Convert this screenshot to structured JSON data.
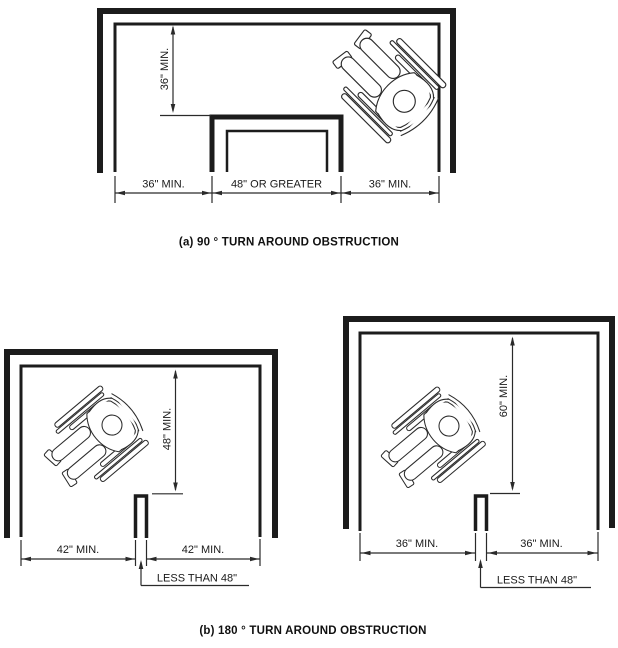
{
  "figure": {
    "background": "#ffffff",
    "line_color": "#1c1c1c",
    "wheelchair_figure": "wheelchair-user-top-view"
  },
  "diagram_a": {
    "title": "90 degree turn around obstruction",
    "caption": "(a) 90 ° TURN AROUND OBSTRUCTION",
    "vertical_dim": "36\" MIN.",
    "bottom_left_dim": "36\" MIN.",
    "bottom_center_dim": "48\" OR GREATER",
    "bottom_right_dim": "36\" MIN."
  },
  "diagram_b_left": {
    "vertical_dim": "48\" MIN.",
    "bottom_left_dim": "42\" MIN.",
    "bottom_right_dim": "42\" MIN.",
    "obstruction_dim": "LESS THAN 48\""
  },
  "diagram_b_right": {
    "vertical_dim": "60\" MIN.",
    "bottom_left_dim": "36\" MIN.",
    "bottom_right_dim": "36\" MIN.",
    "obstruction_dim": "LESS THAN 48\""
  },
  "caption_b": "(b) 180 ° TURN AROUND OBSTRUCTION"
}
